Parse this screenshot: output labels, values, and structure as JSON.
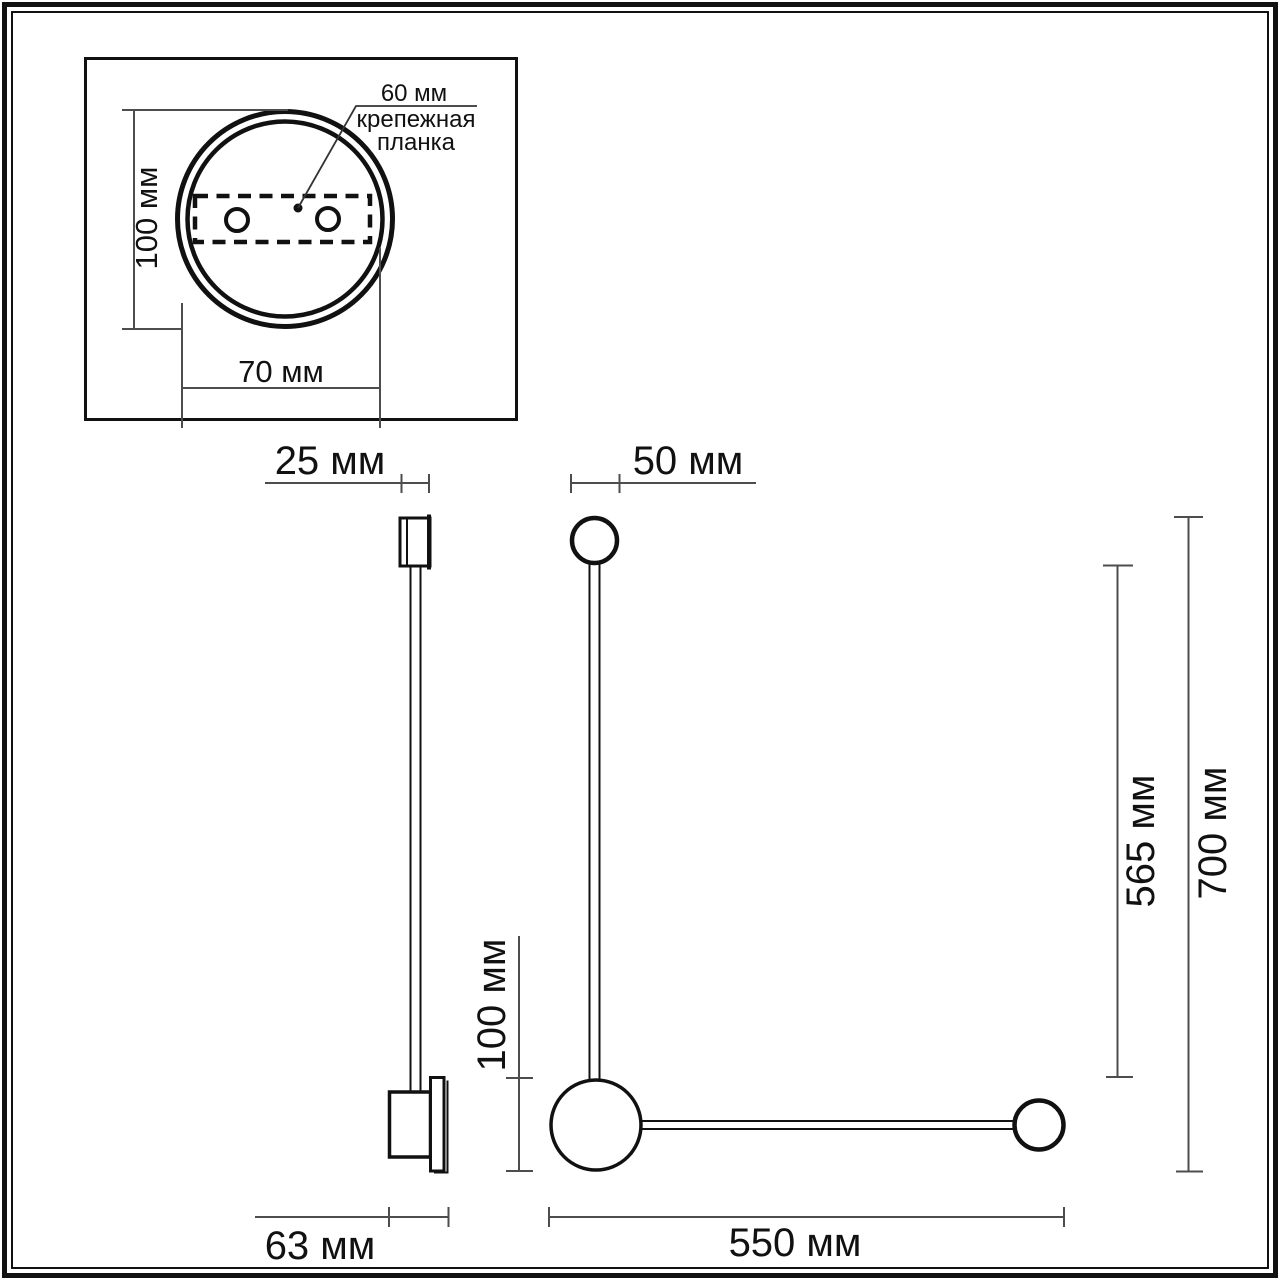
{
  "drawing": {
    "back_view": {
      "height_dim": "100 мм",
      "width_dim": "70 мм",
      "hole_spacing_dim": "60 мм",
      "mounting_plate_label": {
        "line1": "крепежная",
        "line2": "планка"
      }
    },
    "side_view": {
      "cap_width_dim": "25 мм",
      "depth_dim": "63 мм"
    },
    "front_view": {
      "head_diameter_dim": "50 мм",
      "ball_diameter_dim": "100 мм",
      "rod_length_dim": "565 мм",
      "total_height_dim": "700 мм",
      "arm_length_dim": "550 мм"
    }
  },
  "colors": {
    "object_line": "#111111",
    "dimension_line": "#4d4d4d",
    "background": "#ffffff"
  }
}
